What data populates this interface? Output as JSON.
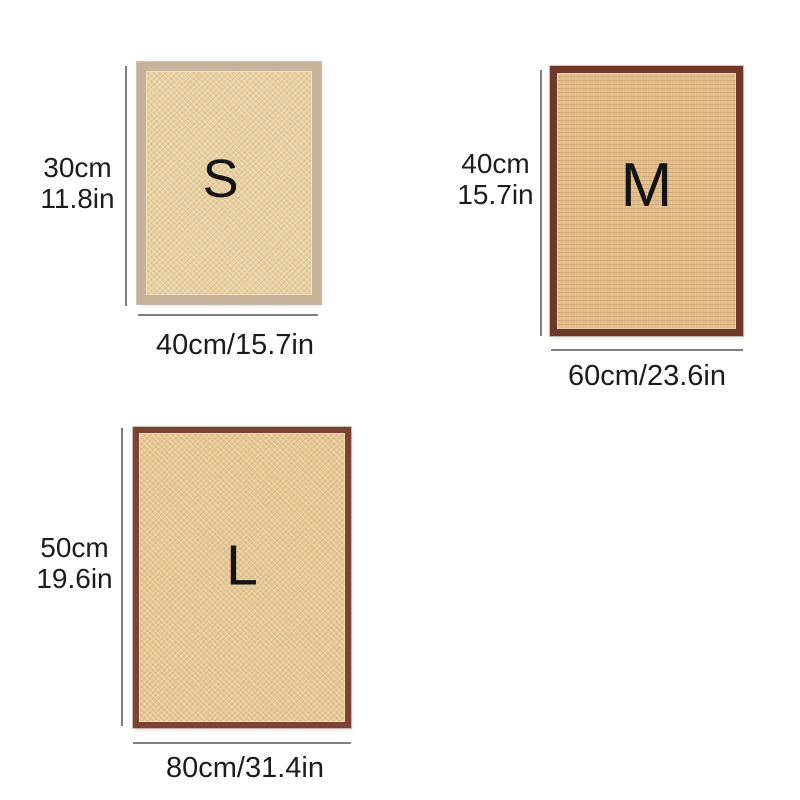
{
  "page": {
    "background_color": "#ffffff",
    "line_color": "#7f7f7f",
    "text_color": "#1c1c1c"
  },
  "mats": [
    {
      "size": "S",
      "letter": "S",
      "height_cm": "30cm",
      "height_in": "11.8in",
      "width_label": "40cm/15.7in",
      "border_color": "#c6b298",
      "surface_color": "#e8cfa0",
      "texture": "diagonal-weave"
    },
    {
      "size": "M",
      "letter": "M",
      "height_cm": "40cm",
      "height_in": "15.7in",
      "width_label": "60cm/23.6in",
      "border_color": "#6f3a29",
      "surface_color": "#e1bc8d",
      "texture": "horizontal-weave"
    },
    {
      "size": "L",
      "letter": "L",
      "height_cm": "50cm",
      "height_in": "19.6in",
      "width_label": "80cm/31.4in",
      "border_color": "#7c4334",
      "surface_color": "#e5c793",
      "texture": "diagonal-weave"
    }
  ]
}
